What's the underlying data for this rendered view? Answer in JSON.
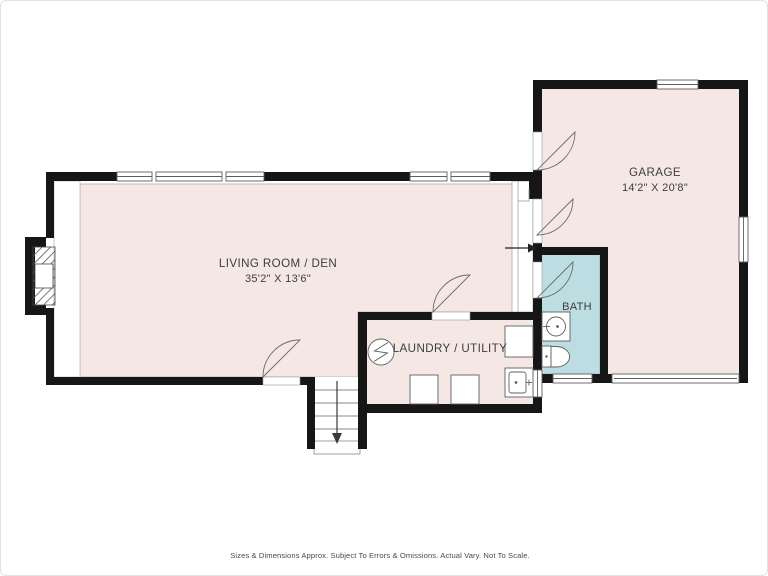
{
  "plan": {
    "type": "floor-plan",
    "rooms": {
      "living": {
        "name": "LIVING ROOM / DEN",
        "dims": "35'2\" X 13'6\""
      },
      "garage": {
        "name": "GARAGE",
        "dims": "14'2\" X 20'8\""
      },
      "laundry": {
        "name": "LAUNDRY / UTILITY"
      },
      "bath": {
        "name": "BATH"
      }
    },
    "fixtures": [
      "fireplace-icon",
      "stairs-down-icon",
      "entry-arrow-icon",
      "washer-icon",
      "dryer-icon",
      "water-heater-icon",
      "utility-sink-icon",
      "appliance-icon",
      "bath-sink-icon",
      "toilet-icon",
      "garage-door",
      "window",
      "door-swing"
    ],
    "colors": {
      "room_fill": "#f5e8e4",
      "bath_fill": "#bcdde1",
      "wall": "#161616",
      "outline": "#a8a8a8",
      "fixture_stroke": "#5f5f5f",
      "text": "#3d3d3d",
      "footer_text": "#4a4a4a"
    }
  },
  "footer": {
    "disclaimer": "Sizes & Dimensions Approx. Subject To Errors & Omissions. Actual Vary. Not To Scale."
  }
}
